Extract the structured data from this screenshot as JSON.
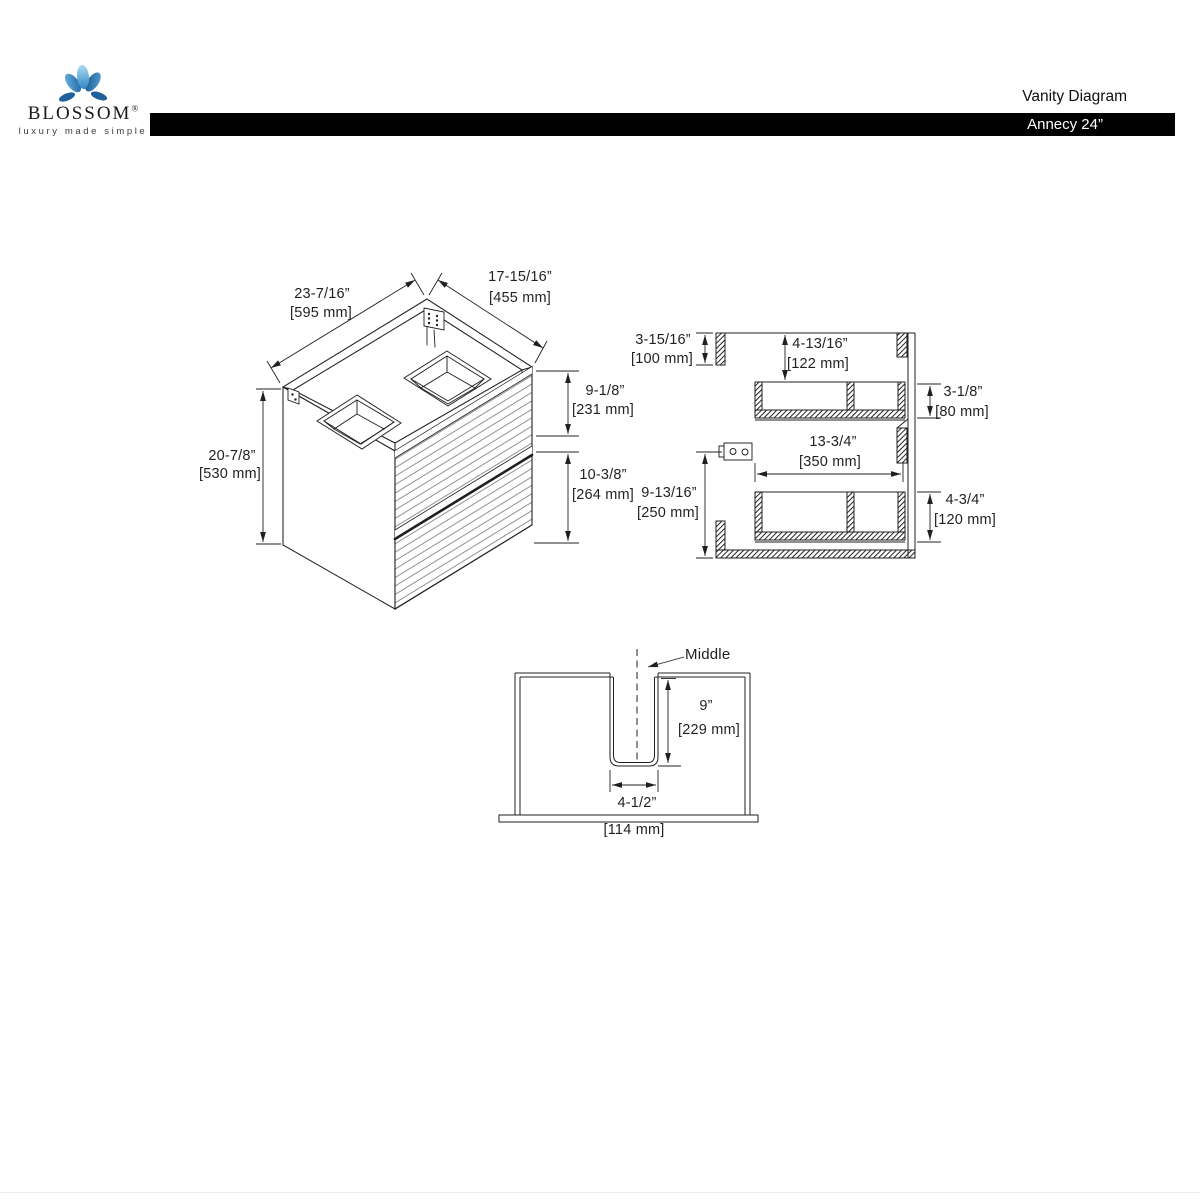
{
  "header": {
    "doc_title": "Vanity Diagram",
    "product": "Annecy 24”",
    "bar_color": "#000000",
    "brand": {
      "name": "BLOSSOM",
      "registered": "®",
      "tagline": "luxury made simple"
    }
  },
  "colors": {
    "line": "#231f20",
    "bar": "#000000",
    "logo_blue_light": "#8ecdee",
    "logo_blue": "#2f86c3",
    "logo_blue_dark": "#1a5e9e"
  },
  "diagrams": {
    "isometric": {
      "name": "Vanity isometric view",
      "dims": {
        "width": {
          "in": "23-7/16”",
          "mm": "[595 mm]"
        },
        "depth": {
          "in": "17-15/16”",
          "mm": "[455 mm]"
        },
        "height": {
          "in": "20-7/8”",
          "mm": "[530 mm]"
        },
        "top_drawer": {
          "in": "9-1/8”",
          "mm": "[231 mm]"
        },
        "bottom_drawer": {
          "in": "10-3/8”",
          "mm": "[264 mm]"
        }
      }
    },
    "section": {
      "name": "Vanity front section view",
      "dims": {
        "backrail_height": {
          "in": "3-15/16”",
          "mm": "[100 mm]"
        },
        "top_clearance": {
          "in": "4-13/16”",
          "mm": "[122 mm]"
        },
        "upper_drawer_depth": {
          "in": "3-1/8”",
          "mm": "[80 mm]"
        },
        "inner_width": {
          "in": "13-3/4”",
          "mm": "[350 mm]"
        },
        "lower_section_height": {
          "in": "9-13/16”",
          "mm": "[250 mm]"
        },
        "lower_drawer_depth": {
          "in": "4-3/4”",
          "mm": "[120 mm]"
        }
      }
    },
    "cutout": {
      "name": "Back panel plumbing cutout view",
      "middle_label": "Middle",
      "dims": {
        "depth": {
          "in": "9”",
          "mm": "[229 mm]"
        },
        "width": {
          "in": "4-1/2”",
          "mm": "[114 mm]"
        }
      }
    }
  }
}
